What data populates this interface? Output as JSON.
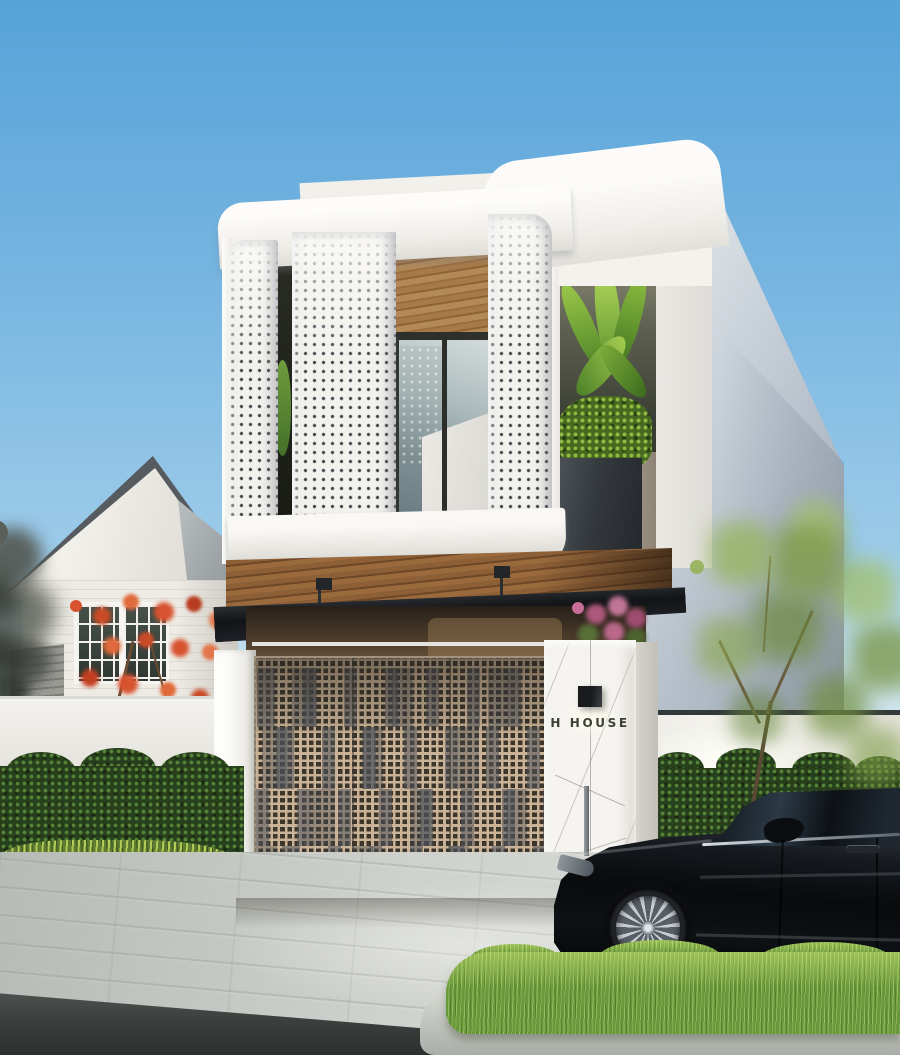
{
  "scene": {
    "type": "architectural exterior render",
    "description": "Modern two-storey white town house with perforated lace-pattern facade screens over a recessed balcony, wood-slat soffit, black louvered canopy, perforated bronze entry gate, marble sign pillar with wall lamp, flanked by a white gabled neighbour house, hedges, a street tree and a black sedan parked at the kerb"
  },
  "sign": {
    "text": "H HOUSE"
  },
  "objects": {
    "main_house": "white two-storey house with perforated screens",
    "balcony": "recessed balcony with wood ceiling and glass sliding doors",
    "planter_niche": "side niche with banana plant in dark planter",
    "canopy": "black louvered steel canopy over entry",
    "gate": "perforated tan metal gate with barcode stripe pattern",
    "sign_pillar": "white marble pillar with black wall lamp and house name",
    "neighbour_house": "white gabled house with paned windows and red flowering shrub",
    "street_tree": "young tree with yellow-green foliage",
    "car": "black luxury sedan, front three-quarter hidden, parked facing left",
    "ground": "grey paver sidewalk, dark asphalt road, bright lawn strip with concrete kerb"
  },
  "palette": {
    "sky-top": "#55a3d8",
    "sky-low": "#cfe6f1",
    "facade-white": "#f6f4f0",
    "wood-brown": "#a0713f",
    "canopy-black": "#17191c",
    "gate-tan": "#c9b295",
    "hedge-green": "#2c431f",
    "lawn": "#68993a",
    "car-black": "#0a0c0f",
    "pavement": "#c9ccc7",
    "road": "#3c403f",
    "flower-red": "#d8532f",
    "flower-pink": "#c76d96",
    "sign-text-color": "#3c4138"
  }
}
